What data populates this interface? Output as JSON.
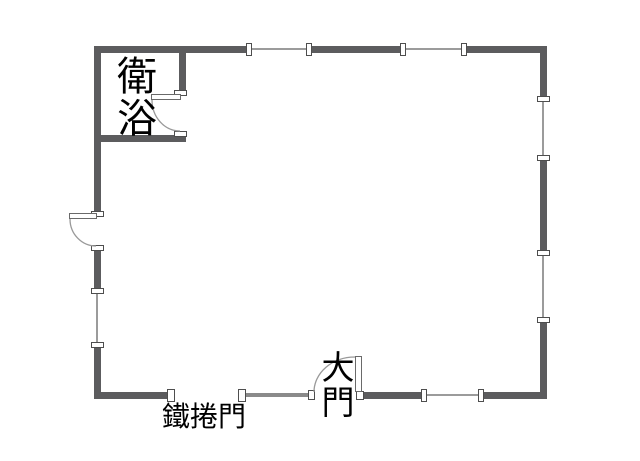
{
  "floorplan": {
    "colors": {
      "background": "#ffffff",
      "wall": "#5c5c5e",
      "medium_line": "#8a8a8a",
      "light_line": "#9b9b9b",
      "text": "#000000"
    },
    "labels": {
      "bathroom": "衛浴",
      "roller_door": "鐵捲門",
      "main_gate": "大門"
    }
  }
}
